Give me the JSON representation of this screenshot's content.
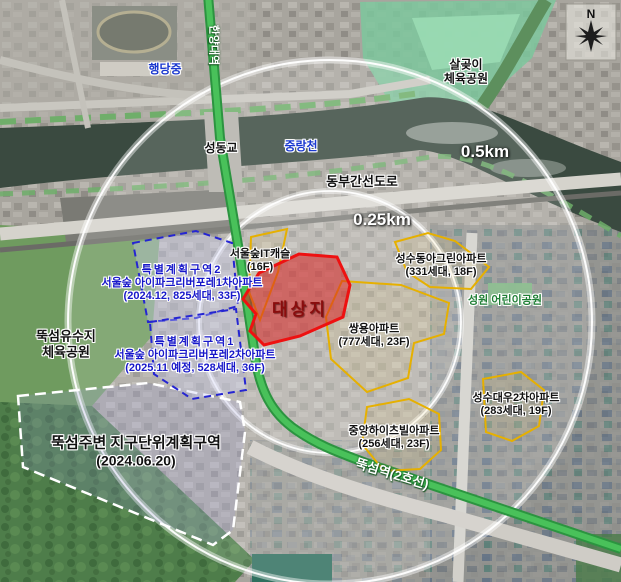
{
  "map": {
    "compass": {
      "north": "N"
    },
    "scale": {
      "outer": "0.5km",
      "inner": "0.25km"
    },
    "places": {
      "hangdang_school": "행당중",
      "hanyang_univ_station": "한양대역",
      "seongdong_bridge": "성동교",
      "jungnang_stream": "중랑천",
      "salgoji_park_line1": "살곶이",
      "salgoji_park_line2": "체육공원",
      "dongbu_expressway": "동부간선도로",
      "yusuji_park_line1": "뚝섬유수지",
      "yusuji_park_line2": "체육공원",
      "seongwon_park": "성원 어린이공원",
      "ttukseom_station": "뚝섬역(2호선)"
    },
    "site": {
      "label": "대상지"
    },
    "special_district_2": {
      "title": "특별계획구역2",
      "name": "서울숲 아이파크리버포레1차아파트",
      "detail": "(2024.12, 825세대, 33F)"
    },
    "special_district_1": {
      "title": "특별계획구역1",
      "name": "서울숲 아이파크리버포레2차아파트",
      "detail": "(2025.11 예정, 528세대, 36F)"
    },
    "ttukseom_district": {
      "title": "뚝섬주변 지구단위계획구역",
      "date": "(2024.06.20)"
    },
    "apartments": {
      "it_castle": {
        "name": "서울숲IT캐슬",
        "detail": "(16F)"
      },
      "ssangyong": {
        "name": "쌍용아파트",
        "detail": "(777세대, 23F)"
      },
      "donga_green": {
        "name": "성수동아그린아파트",
        "detail": "(331세대, 18F)"
      },
      "daewoo2": {
        "name": "성수대우2차아파트",
        "detail": "(283세대, 19F)"
      },
      "jungang_heights": {
        "name": "중앙하이츠빌아파트",
        "detail": "(256세대, 23F)"
      }
    },
    "colors": {
      "site_outline": "#ee1111",
      "site_fill": "#d82020",
      "special_outline": "#2525d2",
      "apartment_outline": "#e6b000",
      "district_outline": "#ffffff",
      "subway_line": "#3cb04a"
    }
  }
}
